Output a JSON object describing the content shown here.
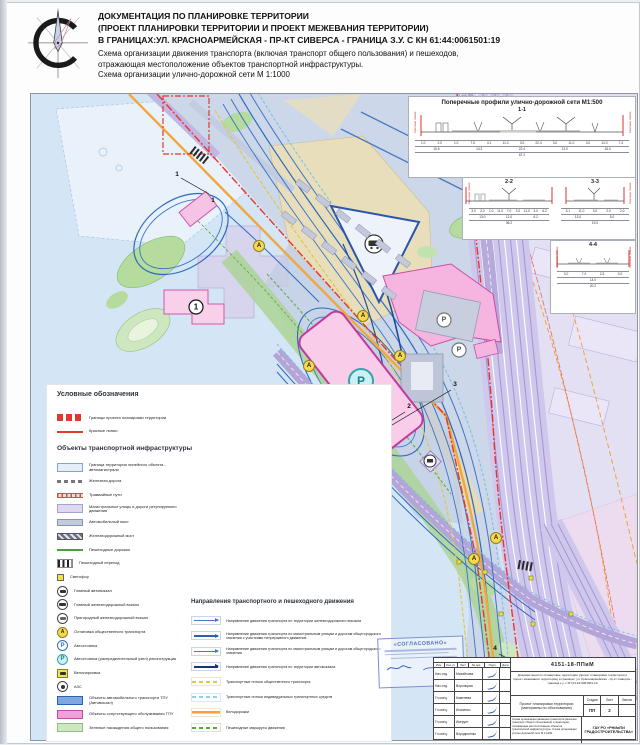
{
  "header": {
    "line1": "ДОКУМЕНТАЦИЯ ПО ПЛАНИРОВКЕ ТЕРРИТОРИИ",
    "line2": "(ПРОЕКТ ПЛАНИРОВКИ ТЕРРИТОРИИ И ПРОЕКТ МЕЖЕВАНИЯ ТЕРРИТОРИИ)",
    "line3": "В ГРАНИЦАХ:УЛ. КРАСНОАРМЕЙСКАЯ - ПР-КТ СИВЕРСА - ГРАНИЦА З.У. С КН 61:44:0061501:19",
    "line4": "Схема организации движения транспорта (включая транспорт общего пользования) и пешеходов,",
    "line5": "отражающая местоположение объектов транспортной инфраструктуры.",
    "line6": "Схема организации улично-дорожной сети  М 1:1000"
  },
  "profiles": {
    "title": "Поперечные профили улично-дорожной сети М1:500",
    "red_lines_label": "Красные линии",
    "sections": [
      {
        "label": "1-1",
        "dims_top": [
          "1.0",
          "2.0",
          "1.0",
          "7.5",
          "4.1",
          "11.0",
          "3.0",
          "22.4",
          "3.0",
          "11.0",
          "3.0",
          "14.0",
          "7.4"
        ],
        "dims_mid": [
          "15.6",
          "14.3",
          "22.4",
          "13.0",
          "15.4"
        ],
        "total": "87.2"
      },
      {
        "label": "2-2",
        "dims_top": [
          "3.0",
          "2.0",
          "1.0",
          "11.0",
          "7.0",
          "3.0",
          "11.0",
          "3.0",
          "6.2"
        ],
        "dims_mid": [
          "13.0",
          "12.0",
          "6.2"
        ],
        "total": "36.2"
      },
      {
        "label": "3-3",
        "dims_top": [
          "3.1",
          "11.0",
          "3.0",
          "2.0",
          "2.0"
        ],
        "dims_mid": [
          "13.0",
          "5.0"
        ],
        "total": "19.0"
      },
      {
        "label": "4-4",
        "dims_top": [
          "3.0",
          "7.0",
          "2.5",
          "3.0"
        ],
        "dims_mid": [
          "14.0"
        ],
        "total": "20.2"
      }
    ]
  },
  "map": {
    "labels": {
      "parking": "Р",
      "stop": "А",
      "terminal_num": "1",
      "cut1": "1",
      "cut2": "2",
      "cut3": "3",
      "cut4": "4"
    }
  },
  "legend": {
    "title_boundaries": "Условные обозначения",
    "title_objects": "Объекты транспортной инфраструктуры",
    "title_directions": "Направления транспортного и пешеходного движения",
    "boundaries": [
      {
        "swatch": "red-blocks",
        "label": "Границы проекта планировки территории"
      },
      {
        "swatch": "red-line",
        "label": "Красные линии"
      }
    ],
    "objects": [
      {
        "swatch": "box-lblue",
        "label": "Граница территории линейного объекта - автомагистрали"
      },
      {
        "swatch": "rail-line",
        "label": "Железная дорога"
      },
      {
        "swatch": "tram-line",
        "label": "Трамвайные пути"
      },
      {
        "swatch": "box-purple",
        "label": "Магистральные улицы и дороги регулируемого движения"
      },
      {
        "swatch": "bridge-auto",
        "label": "Автомобильный мост"
      },
      {
        "swatch": "bridge-rail",
        "label": "Железнодорожный мост"
      },
      {
        "swatch": "green-line",
        "label": "Пешеходные дорожки"
      },
      {
        "swatch": "zebra",
        "label": "Пешеходный переход"
      },
      {
        "swatch": "traffic",
        "icon": "traffic-light-icon",
        "label": "Светофор"
      },
      {
        "swatch": "icon-bus",
        "icon": "bus-terminal-icon",
        "label": "Главный автовокзал"
      },
      {
        "swatch": "icon-train",
        "icon": "railway-station-icon",
        "label": "Главный железнодорожный вокзал"
      },
      {
        "swatch": "icon-train2",
        "icon": "suburban-station-icon",
        "label": "Пригородный железнодорожный вокзал"
      },
      {
        "swatch": "icon-stop",
        "icon": "transit-stop-icon",
        "letter": "А",
        "label": "Остановка общественного транспорта"
      },
      {
        "swatch": "icon-park",
        "icon": "parking-icon",
        "letter": "Р",
        "label": "Автостоянка"
      },
      {
        "swatch": "icon-park2",
        "icon": "parking-hub-icon",
        "letter": "Р",
        "label": "Автостоянка (распределительный узел) реконструкция"
      },
      {
        "swatch": "icon-bike",
        "icon": "bike-parking-icon",
        "label": "Велопарковка"
      },
      {
        "swatch": "icon-azs",
        "icon": "gas-station-icon",
        "label": "АЗС"
      },
      {
        "swatch": "box-blue",
        "label": "Объекты автомобильного транспорта ТПУ (Автовокзал)"
      },
      {
        "swatch": "box-pink",
        "label": "Объекты сопутствующего обслуживания ТПУ"
      },
      {
        "swatch": "box-green",
        "label": "Зеленые насаждения общего пользования"
      }
    ],
    "directions": [
      {
        "swatch": "arr-zhd",
        "label": "Направление движения транспорта по территории железнодорожного вокзала"
      },
      {
        "swatch": "arr-nepr",
        "label": "Направление движения транспорта по магистральным улицам и дорогам общегородского значения с участками непрерывного движения"
      },
      {
        "swatch": "arr-mag",
        "label": "Направление движения транспорта по магистральным улицам и дорогам общегородского значения"
      },
      {
        "swatch": "arr-avto",
        "label": "Направление движения транспорта по территории автовокзала"
      },
      {
        "swatch": "dash-yellow",
        "label": "Транспортные потоки общественного транспорта"
      },
      {
        "swatch": "dash-cyan",
        "label": "Транспортные потоки индивидуальных транспортных средств"
      },
      {
        "swatch": "line-orange",
        "label": "Велодорожки"
      },
      {
        "swatch": "dash-green",
        "label": "Пешеходные маршруты движения"
      }
    ]
  },
  "stamp": {
    "title": "«СОГЛАСОВАНО»"
  },
  "titleblock": {
    "doc_number": "4151-18-ППиМ",
    "description": "Документация по планировке территории (проект планировки территории и проект межевания территории) в границах: ул. Красноармейская - пр-кт Сиверса - граница з.у. с КН 61:44:0061501:19",
    "project": "Проект планировки территории (материалы по обоснованию)",
    "stage_label": "Стадия",
    "sheet_label": "Лист",
    "sheets_label": "Листов",
    "stage": "ПП",
    "sheet": "2",
    "sheet_name": "Схема организации движения транспорта (включая транспорт общего пользования) и пешеходов, отражающая местоположение объектов транспортной инфраструктуры. Схема организации улично-дорожной сети М 1:1000",
    "org": "ГАУ РО «РНИиПИ ГРАДОСТРОИТЕЛЬСТВА»",
    "header_cells": [
      "Изм.",
      "Кол.уч.",
      "Лист",
      "№ док.",
      "Подп.",
      "Дата"
    ],
    "rows": [
      {
        "role": "Нач.отд.",
        "name": "Михайлова"
      },
      {
        "role": "Нач.отд.",
        "name": "Воронцова"
      },
      {
        "role": "Гл.спец.",
        "name": "Каменева"
      },
      {
        "role": "Гл.спец.",
        "name": "Исаченко"
      },
      {
        "role": "Гл.спец.",
        "name": "Имгрунт"
      },
      {
        "role": "Гл.спец.",
        "name": "Вородиченко"
      }
    ]
  }
}
